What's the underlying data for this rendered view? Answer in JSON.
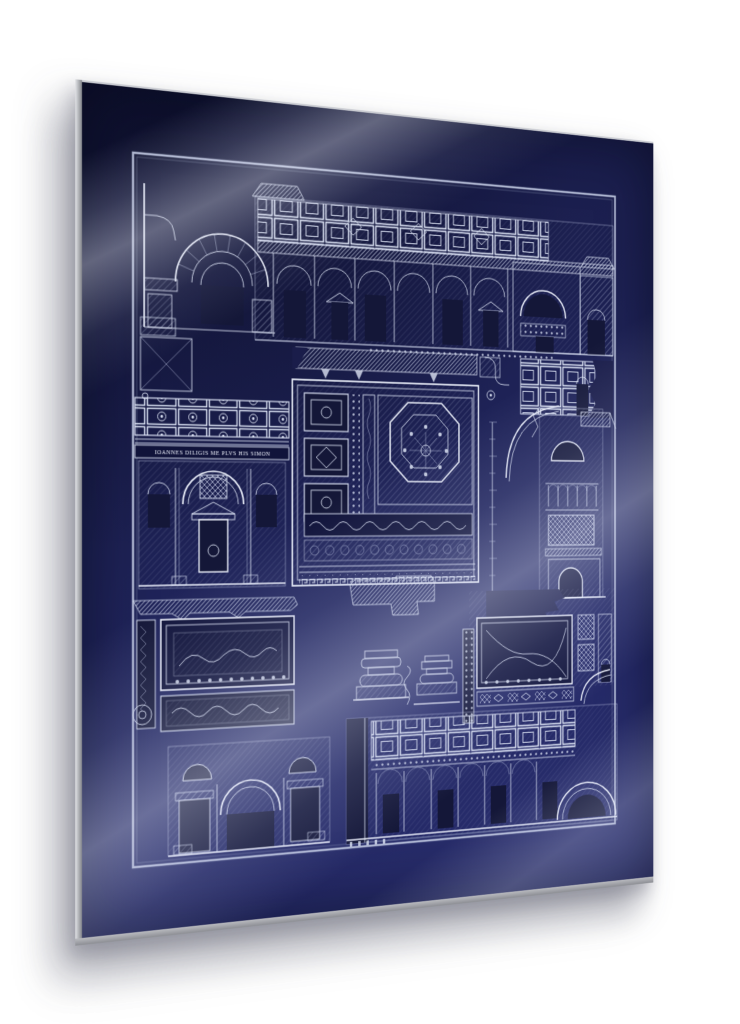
{
  "artwork": {
    "inscription": "IOANNES DILIGIS ME PLVS HIS SIMON",
    "plates": [
      "transverse-section-with-coffered-arch-and-plan",
      "nave-interior-elevation",
      "ceiling-coffer-fragment",
      "coffered-ceiling-with-inscription-frieze-and-aedicule",
      "ornamental-ceiling-panel-with-octagon-rosette",
      "tower-section-with-scale-bar",
      "mosaic-border-fragment",
      "pier-plan-and-column-bases",
      "soffit-coffer-ornament-with-arch-detail",
      "arched-wall-elevation",
      "coffered-arcade-elevation"
    ]
  },
  "colors": {
    "page_background": "#ffffff",
    "panel_navy": "#1c2050",
    "panel_navy_deep": "#141738",
    "engraving_silver": "#dde4f4",
    "panel_edge_gray": "#a9aaae",
    "reflection_sheen": "#c9cee8",
    "shadow": "rgba(35,37,55,0.4)"
  }
}
